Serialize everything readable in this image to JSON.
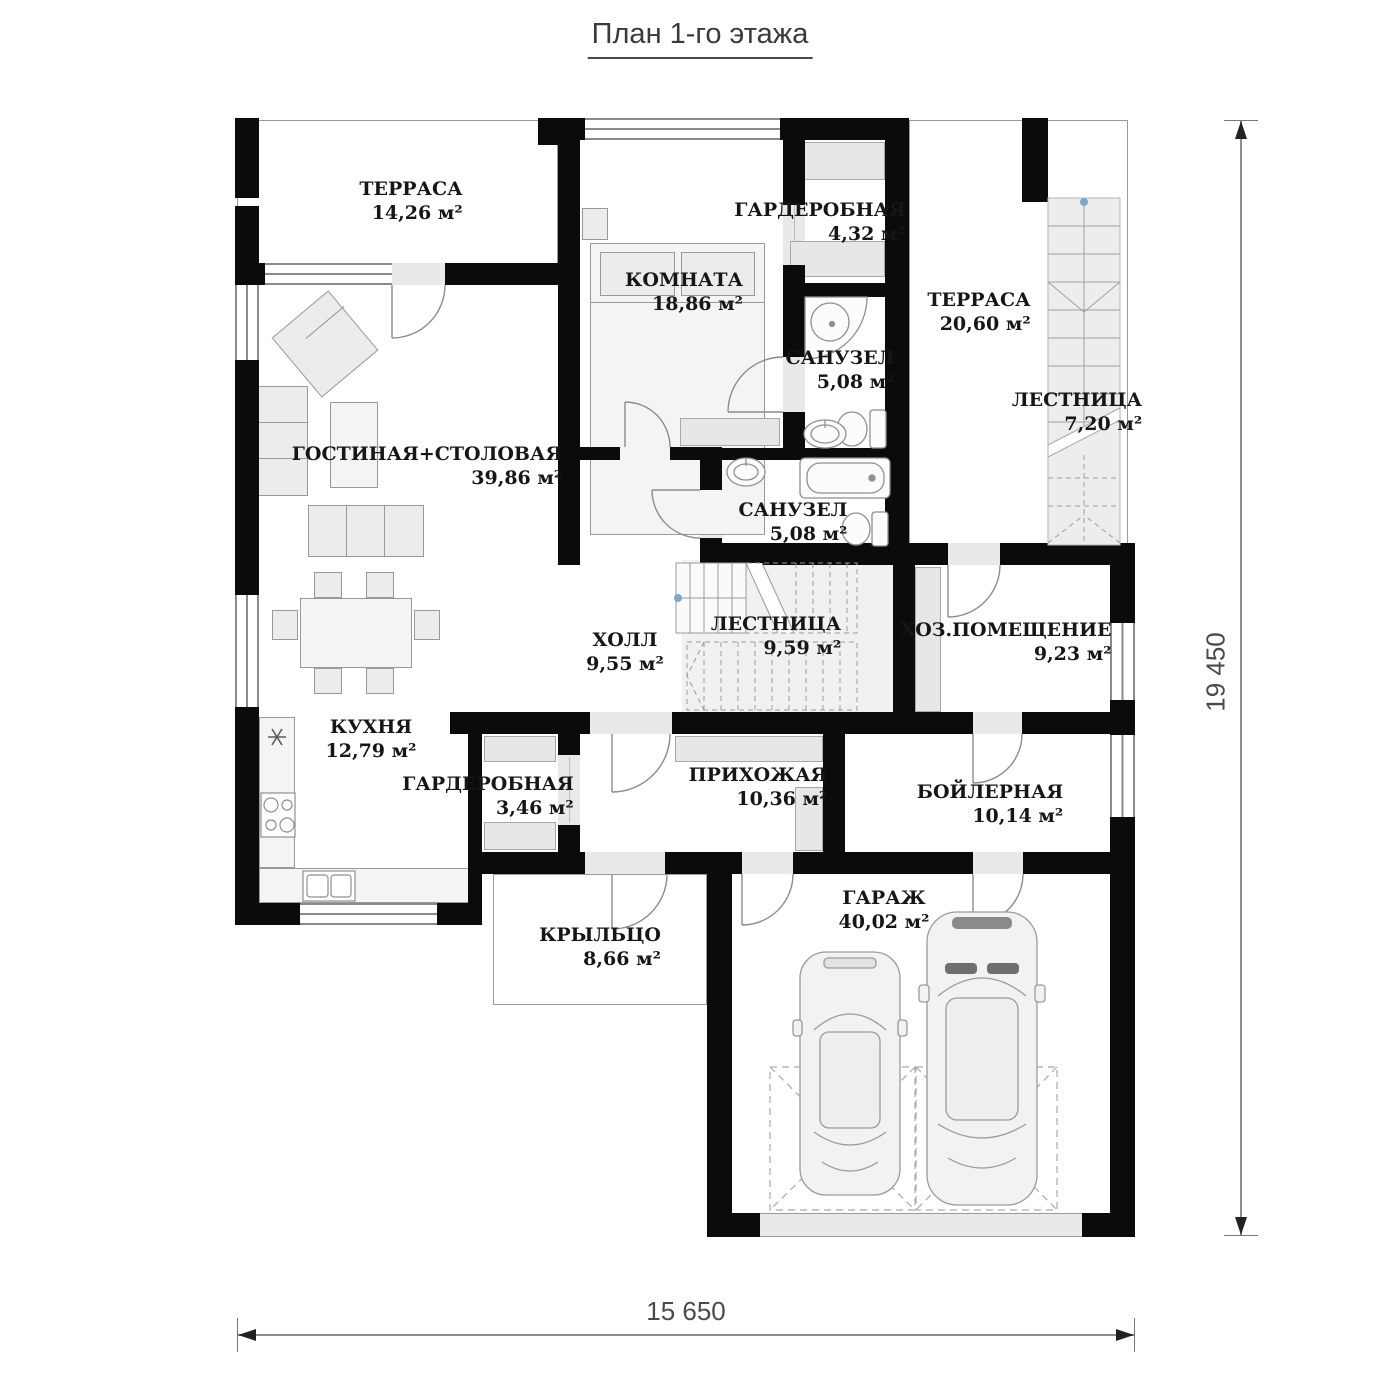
{
  "title": "План 1-го этажа",
  "rooms": {
    "terrace_tl": {
      "name": "ТЕРРАСА",
      "area": "14,26 м²"
    },
    "bedroom": {
      "name": "КОМНАТА",
      "area": "18,86 м²"
    },
    "wardrobe_top": {
      "name": "ГАРДЕРОБНАЯ",
      "area": "4,32 м²"
    },
    "bath_top": {
      "name": "САНУЗЕЛ",
      "area": "5,08 м²"
    },
    "terrace_right": {
      "name": "ТЕРРАСА",
      "area": "20,60 м²"
    },
    "stairs_right": {
      "name": "ЛЕСТНИЦА",
      "area": "7,20 м²"
    },
    "living": {
      "name": "ГОСТИНАЯ+СТОЛОВАЯ",
      "area": "39,86 м²"
    },
    "bath_bottom": {
      "name": "САНУЗЕЛ",
      "area": "5,08 м²"
    },
    "hall": {
      "name": "ХОЛЛ",
      "area": "9,55 м²"
    },
    "stairs_center": {
      "name": "ЛЕСТНИЦА",
      "area": "9,59 м²"
    },
    "utility": {
      "name": "ХОЗ.ПОМЕЩЕНИЕ",
      "area": "9,23 м²"
    },
    "kitchen": {
      "name": "КУХНЯ",
      "area": "12,79 м²"
    },
    "wardrobe_bottom": {
      "name": "ГАРДЕРОБНАЯ",
      "area": "3,46 м²"
    },
    "entry": {
      "name": "ПРИХОЖАЯ",
      "area": "10,36 м²"
    },
    "boiler": {
      "name": "БОЙЛЕРНАЯ",
      "area": "10,14 м²"
    },
    "porch": {
      "name": "КРЫЛЬЦО",
      "area": "8,66 м²"
    },
    "garage": {
      "name": "ГАРАЖ",
      "area": "40,02 м²"
    }
  },
  "dimensions": {
    "width_label": "15 650",
    "height_label": "19 450"
  },
  "colors": {
    "wall": "#0b0b0b",
    "floor_gray": "#ececec",
    "marker_blue": "#7ba7d7"
  }
}
